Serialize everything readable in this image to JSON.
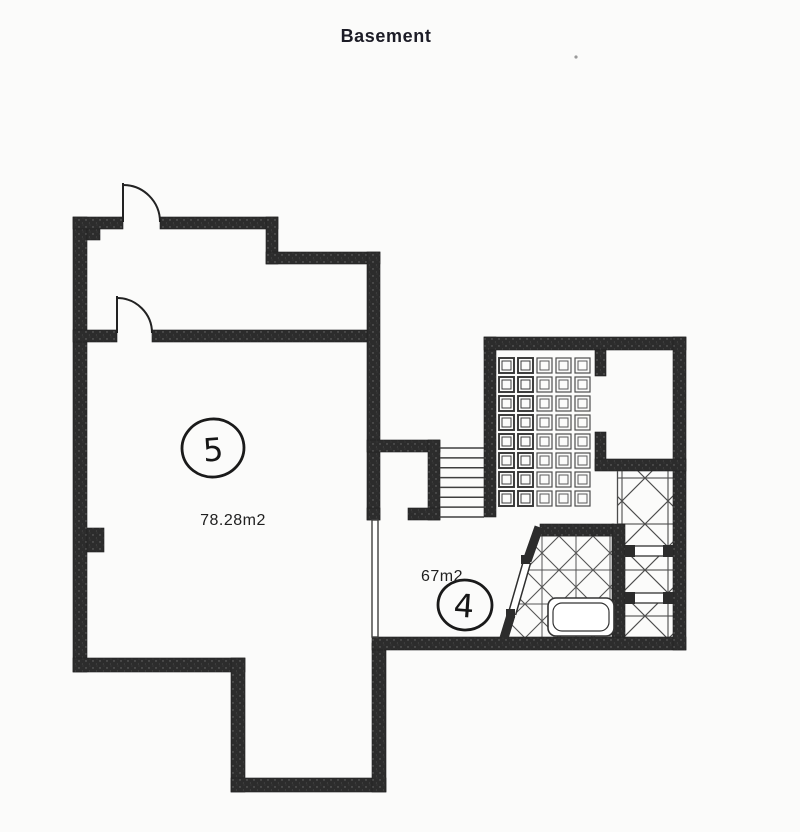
{
  "document": {
    "title": "Basement",
    "type": "scanned-floor-plan"
  },
  "palette": {
    "paper": "#fbfbfa",
    "wall": "#2c2c2c",
    "wall_speck": "#6e6e6e",
    "thin_line": "#3f3f3f",
    "tile_line": "#4c4c4c",
    "text": "#1c1c26"
  },
  "rooms": [
    {
      "id": "room-5",
      "number": "5",
      "area_label": "78.28m2"
    },
    {
      "id": "room-4",
      "number": "4",
      "area_label": "67m2"
    }
  ],
  "features": {
    "tile_grid": {
      "cols": 5,
      "rows": 8
    },
    "stairs": {
      "treads": 8
    },
    "swing_doors": 2,
    "diagonal_door": 1,
    "bathtub": 1,
    "shelf_partitions": 2
  }
}
